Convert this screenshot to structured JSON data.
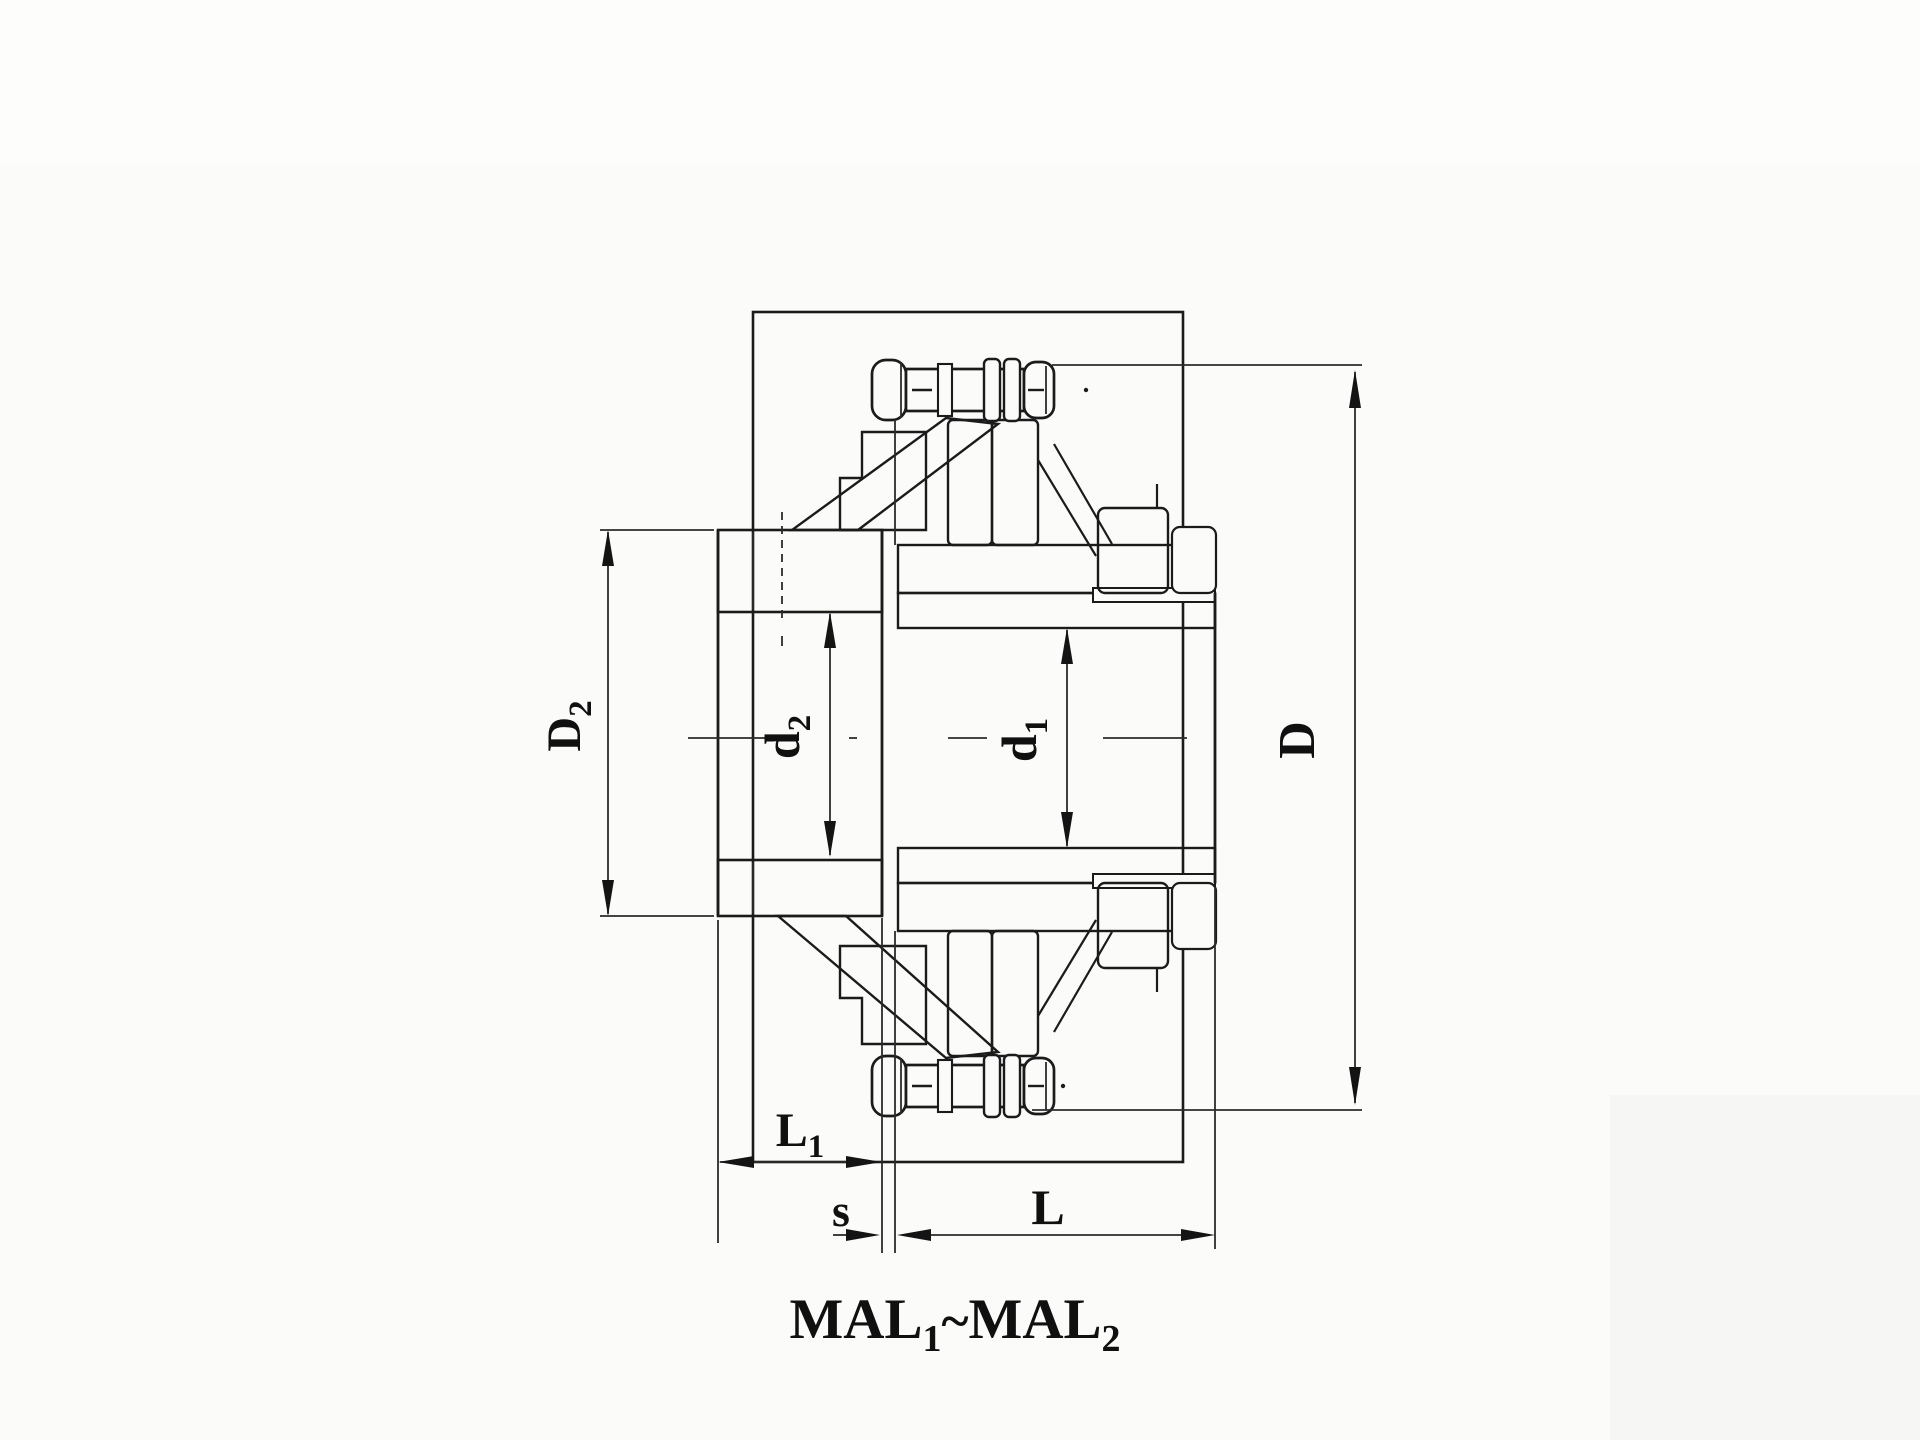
{
  "page": {
    "background": "#fbfbf9",
    "ink_color": "#1b1b1b"
  },
  "drawing": {
    "kind": "coupling cross-section",
    "title": {
      "series_left": "MAL",
      "series_left_sub": "1",
      "separator": "~",
      "series_right": "MAL",
      "series_right_sub": "2"
    },
    "dimensions": {
      "left_flange_diameter": {
        "label": "D",
        "sub": "2"
      },
      "left_bore_diameter": {
        "label": "d",
        "sub": "2"
      },
      "right_bore_diameter": {
        "label": "d",
        "sub": "1"
      },
      "outer_diameter": {
        "label": "D",
        "sub": ""
      },
      "left_hub_length": {
        "label": "L",
        "sub": "1"
      },
      "flange_gap": {
        "label": "s",
        "sub": ""
      },
      "coupling_length": {
        "label": "L",
        "sub": ""
      }
    }
  }
}
